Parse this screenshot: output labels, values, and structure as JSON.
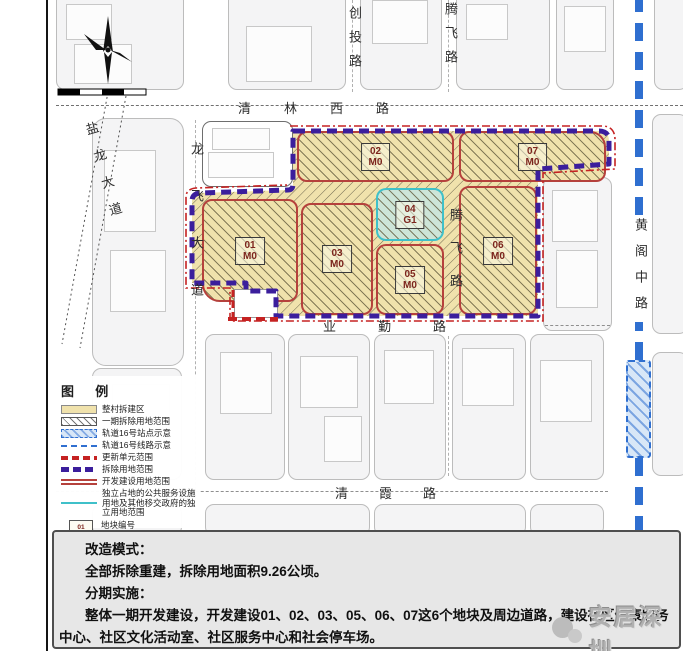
{
  "sidebar": {
    "title": "改造模式与分期实施规划图（修改后）"
  },
  "map": {
    "roads": {
      "qinglin_west": "清林西路",
      "chuangtou": "创投路",
      "tengfei": "腾飞路",
      "longfei": "龙飞大道",
      "yanlong": "盐龙大道",
      "huangge_middle": "黄阁中路",
      "yeqin": "业勤路",
      "qingxia": "清霞路"
    },
    "plots": [
      {
        "id": "01",
        "use": "M0"
      },
      {
        "id": "02",
        "use": "M0"
      },
      {
        "id": "03",
        "use": "M0"
      },
      {
        "id": "04",
        "use": "G1"
      },
      {
        "id": "05",
        "use": "M0"
      },
      {
        "id": "06",
        "use": "M0"
      },
      {
        "id": "07",
        "use": "M0"
      }
    ],
    "colors": {
      "demolition_boundary": "#3b1e9c",
      "unit_boundary": "#c52222",
      "plot_border": "#b5413c",
      "plot_fill": "#f0e2ac",
      "public_facility": "#3fc0c9",
      "metro_line": "#2f6fd0"
    }
  },
  "legend": {
    "title": "图 例",
    "items": [
      {
        "label": "整村拆建区"
      },
      {
        "label": "一期拆除用地范围"
      },
      {
        "label": "轨道16号站点示意"
      },
      {
        "label": "轨道16号线路示意"
      },
      {
        "label": "更新单元范围"
      },
      {
        "label": "拆除用地范围"
      },
      {
        "label": "开发建设用地范围"
      },
      {
        "label": "独立占地的公共服务设施用地及其他移交政府的独立用地范围"
      }
    ],
    "sample": {
      "id": "01",
      "use": "M0"
    },
    "sample_labels": [
      "地块编号",
      "用地性质"
    ]
  },
  "notes": {
    "line1": "改造模式：",
    "line2": "全部拆除重建，拆除用地面积9.26公顷。",
    "line3": "分期实施：",
    "line4": "整体一期开发建设，开发建设01、02、03、05、06、07这6个地块及周边道路，建设社区健康服务中心、社区文化活动室、社区服务中心和社会停车场。"
  },
  "watermark": "安居深圳"
}
